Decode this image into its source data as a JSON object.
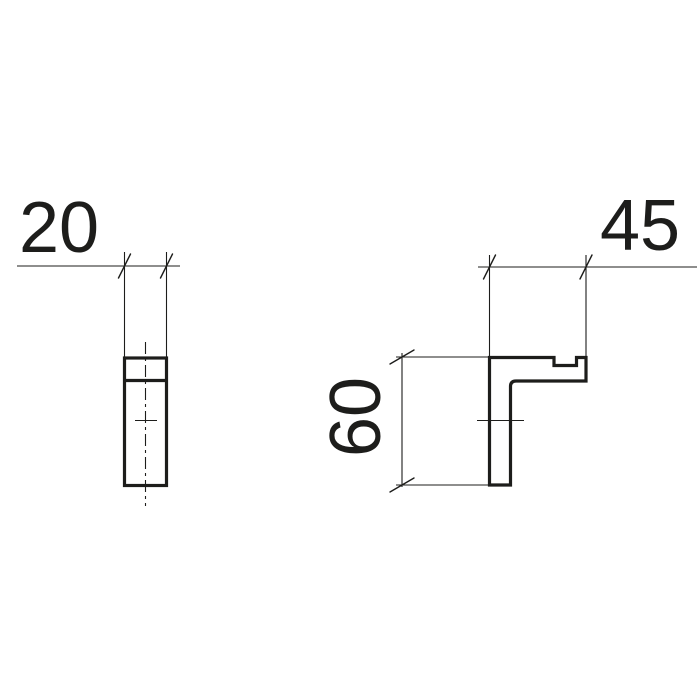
{
  "document": {
    "type": "technical-dimension-drawing",
    "background_color": "#ffffff",
    "line_color": "#1d1d1b"
  },
  "drawing": {
    "views": [
      {
        "id": "front-view"
      },
      {
        "id": "side-view"
      }
    ],
    "dimensions": [
      {
        "id": "width",
        "label": "20"
      },
      {
        "id": "depth",
        "label": "45"
      },
      {
        "id": "height",
        "label": "60"
      }
    ]
  }
}
